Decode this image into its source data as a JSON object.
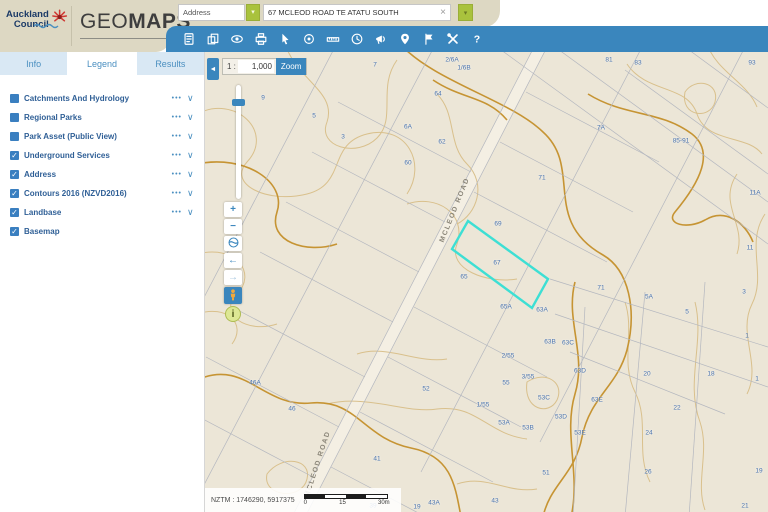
{
  "header": {
    "logo": {
      "line1": "Auckland",
      "line2": "Council"
    },
    "title": {
      "light": "GEO",
      "bold": "MAPS"
    },
    "search": {
      "category": "Address",
      "category_caret": "▾",
      "query": "67 MCLEOD ROAD TE ATATU SOUTH",
      "clear_glyph": "×",
      "go_caret": "▾"
    }
  },
  "toolbar": {
    "icons": [
      "property-report",
      "copy-map",
      "show-hide-layers",
      "print",
      "select",
      "locate",
      "measure",
      "history",
      "announcements",
      "add-pin",
      "bookmark",
      "tools",
      "help"
    ]
  },
  "sidebar": {
    "tabs": [
      {
        "label": "Info",
        "active": false
      },
      {
        "label": "Legend",
        "active": true
      },
      {
        "label": "Results",
        "active": false
      }
    ],
    "layers": [
      {
        "label": "Catchments And Hydrology",
        "check": "",
        "menu": "•••",
        "chevron": "∨"
      },
      {
        "label": "Regional Parks",
        "check": "",
        "menu": "•••",
        "chevron": "∨"
      },
      {
        "label": "Park Asset (Public View)",
        "check": "",
        "menu": "•••",
        "chevron": "∨"
      },
      {
        "label": "Underground Services",
        "check": "✓",
        "menu": "•••",
        "chevron": "∨"
      },
      {
        "label": "Address",
        "check": "✓",
        "menu": "•••",
        "chevron": "∨"
      },
      {
        "label": "Contours 2016 (NZVD2016)",
        "check": "✓",
        "menu": "•••",
        "chevron": "∨"
      },
      {
        "label": "Landbase",
        "check": "✓",
        "menu": "•••",
        "chevron": "∨"
      },
      {
        "label": "Basemap",
        "check": "✓",
        "menu": "",
        "chevron": ""
      }
    ]
  },
  "map": {
    "scale": {
      "prefix": "1 :",
      "value": "1,000",
      "zoom_button": "Zoom"
    },
    "controls": {
      "collapse": "◄",
      "zoom_in": "+",
      "zoom_out": "−",
      "back": "←",
      "forward": "→",
      "info": "i"
    },
    "highlight": {
      "parcel_number": "67",
      "points": "263,169 343,227 327,256 247,197"
    },
    "road_labels": [
      {
        "text": "MCLEOD ROAD",
        "x": 250,
        "y": 158,
        "angle": -68
      },
      {
        "text": "MCLEOD ROAD",
        "x": 113,
        "y": 412,
        "angle": -72
      }
    ],
    "labels": [
      {
        "t": "9",
        "x": 58,
        "y": 46
      },
      {
        "t": "7",
        "x": 170,
        "y": 13
      },
      {
        "t": "5",
        "x": 109,
        "y": 64
      },
      {
        "t": "3",
        "x": 138,
        "y": 85
      },
      {
        "t": "2/6A",
        "x": 247,
        "y": 8
      },
      {
        "t": "1/6B",
        "x": 259,
        "y": 16
      },
      {
        "t": "64",
        "x": 233,
        "y": 42
      },
      {
        "t": "6A",
        "x": 203,
        "y": 75
      },
      {
        "t": "62",
        "x": 237,
        "y": 90
      },
      {
        "t": "60",
        "x": 203,
        "y": 111
      },
      {
        "t": "71",
        "x": 337,
        "y": 126
      },
      {
        "t": "81",
        "x": 404,
        "y": 8
      },
      {
        "t": "83",
        "x": 433,
        "y": 11
      },
      {
        "t": "93",
        "x": 547,
        "y": 11
      },
      {
        "t": "85-91",
        "x": 476,
        "y": 89
      },
      {
        "t": "7A",
        "x": 396,
        "y": 76
      },
      {
        "t": "11A",
        "x": 550,
        "y": 141
      },
      {
        "t": "11",
        "x": 545,
        "y": 196
      },
      {
        "t": "3",
        "x": 539,
        "y": 240
      },
      {
        "t": "5A",
        "x": 444,
        "y": 245
      },
      {
        "t": "5",
        "x": 482,
        "y": 260
      },
      {
        "t": "1",
        "x": 542,
        "y": 284
      },
      {
        "t": "1",
        "x": 552,
        "y": 327
      },
      {
        "t": "69",
        "x": 293,
        "y": 172
      },
      {
        "t": "67",
        "x": 292,
        "y": 211
      },
      {
        "t": "65",
        "x": 259,
        "y": 225
      },
      {
        "t": "71",
        "x": 396,
        "y": 236
      },
      {
        "t": "65A",
        "x": 301,
        "y": 255
      },
      {
        "t": "63A",
        "x": 337,
        "y": 258
      },
      {
        "t": "63B",
        "x": 345,
        "y": 290
      },
      {
        "t": "63C",
        "x": 363,
        "y": 291
      },
      {
        "t": "63D",
        "x": 375,
        "y": 319
      },
      {
        "t": "63E",
        "x": 392,
        "y": 348
      },
      {
        "t": "2/55",
        "x": 303,
        "y": 304
      },
      {
        "t": "3/55",
        "x": 323,
        "y": 325
      },
      {
        "t": "55",
        "x": 301,
        "y": 331
      },
      {
        "t": "53C",
        "x": 339,
        "y": 346
      },
      {
        "t": "53A",
        "x": 299,
        "y": 371
      },
      {
        "t": "53B",
        "x": 323,
        "y": 376
      },
      {
        "t": "53D",
        "x": 356,
        "y": 365
      },
      {
        "t": "53E",
        "x": 375,
        "y": 381
      },
      {
        "t": "51",
        "x": 341,
        "y": 421
      },
      {
        "t": "20",
        "x": 442,
        "y": 322
      },
      {
        "t": "22",
        "x": 472,
        "y": 356
      },
      {
        "t": "24",
        "x": 444,
        "y": 381
      },
      {
        "t": "26",
        "x": 443,
        "y": 420
      },
      {
        "t": "18",
        "x": 506,
        "y": 322
      },
      {
        "t": "19",
        "x": 554,
        "y": 419
      },
      {
        "t": "21",
        "x": 540,
        "y": 454
      },
      {
        "t": "46A",
        "x": 50,
        "y": 331
      },
      {
        "t": "46",
        "x": 87,
        "y": 357
      },
      {
        "t": "52",
        "x": 221,
        "y": 337
      },
      {
        "t": "1/55",
        "x": 278,
        "y": 353
      },
      {
        "t": "41",
        "x": 172,
        "y": 407
      },
      {
        "t": "39",
        "x": 168,
        "y": 454
      },
      {
        "t": "43A",
        "x": 229,
        "y": 451
      },
      {
        "t": "43",
        "x": 290,
        "y": 449
      },
      {
        "t": "19",
        "x": 212,
        "y": 455
      }
    ],
    "statusbar": {
      "coords": "NZTM : 1746290, 5917375",
      "scalebar_ticks": [
        "0",
        "15",
        "30m"
      ]
    }
  },
  "colors": {
    "header-blue": "#3a86bd",
    "beige": "#ddd8c3",
    "logo-navy": "#1b3a67",
    "flower-red": "#cf3832",
    "green": "#a9c23d",
    "tab-blue": "#4a8fc0",
    "tab-bg": "#d9e8f4",
    "layer-text": "#2f5f96",
    "checkbox-blue": "#3a7fc0",
    "map-bg": "#ece6d7",
    "contour": "#d9c08c",
    "contour-index": "#c69433",
    "cadastre": "#b4b7bf",
    "map-label": "#4a74b0",
    "highlight": "#3ddfd4",
    "control-blue": "#3a86bd"
  }
}
